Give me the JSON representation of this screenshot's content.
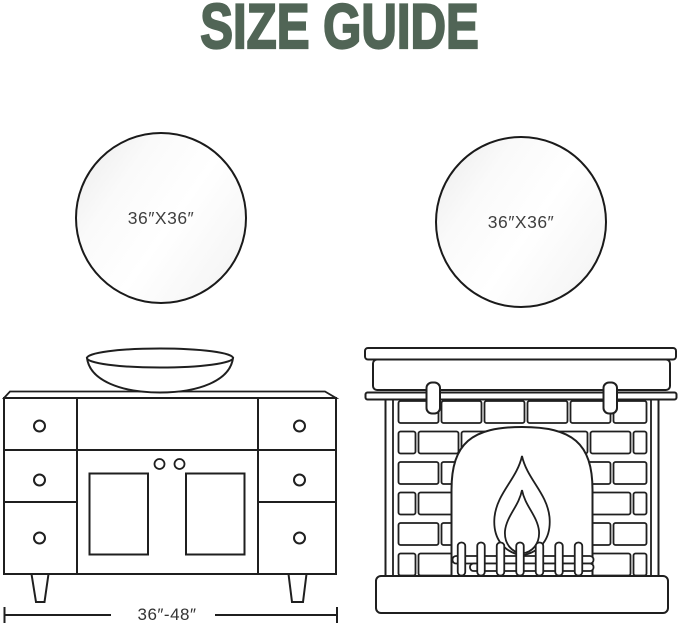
{
  "title": "SIZE GUIDE",
  "mirrors": {
    "left": {
      "label": "36″X36″"
    },
    "right": {
      "label": "36″X36″"
    }
  },
  "vanity": {
    "width_label": "36″-48″"
  },
  "colors": {
    "background": "#ffffff",
    "title_text": "#516556",
    "line_art": "#1f1f1f",
    "mirror_frame": "#1a1a1a",
    "label_text": "#3f3f3f",
    "dimension_text": "#333333"
  }
}
